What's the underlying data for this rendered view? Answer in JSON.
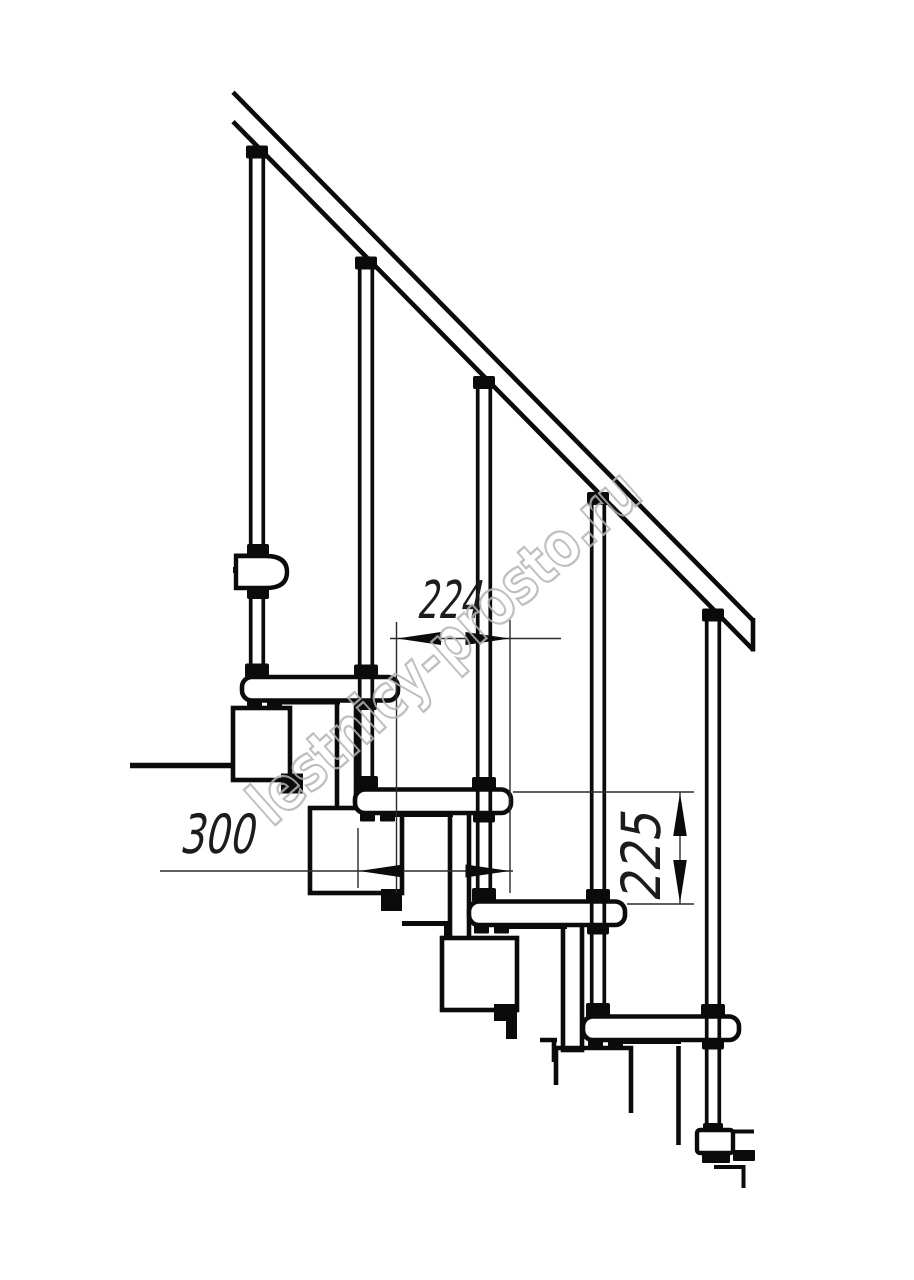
{
  "diagram": {
    "kind": "staircase-technical-drawing",
    "watermark": "lestnicy-prosto.ru",
    "dimensions": {
      "run_between_steps": "224",
      "tread_depth": "300",
      "step_rise": "225"
    },
    "colors": {
      "ink": "#0b0b0b",
      "dimension_ink": "#1c1c1c",
      "watermark": "#b4b4b4",
      "background": "#ffffff"
    }
  }
}
